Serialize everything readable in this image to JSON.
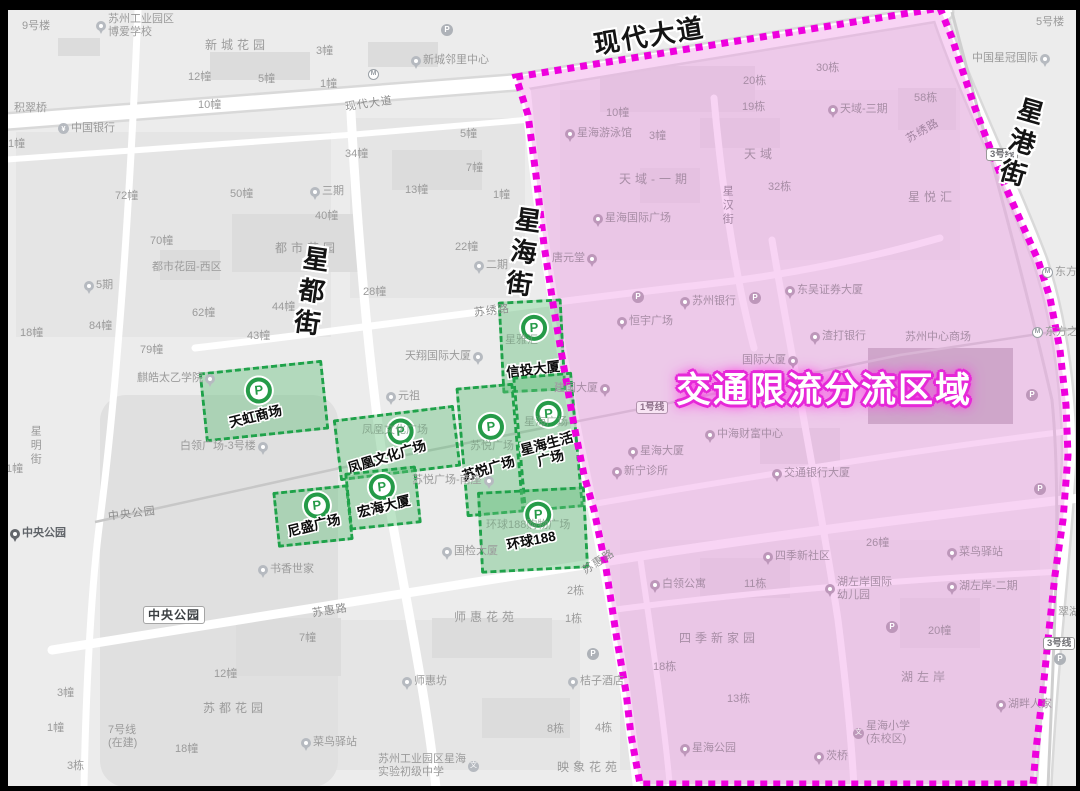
{
  "region": {
    "label": "交通限流分流区域",
    "title_x": 676,
    "title_y": 362,
    "border_color": "#ee00dd",
    "fill_color": "#ef9fe6"
  },
  "glyphs": {
    "parking": "P",
    "metro": "M",
    "school": "文",
    "bank": "¥"
  },
  "colors": {
    "zone_border": "#1fa24a",
    "zone_fill": "rgba(97,191,122,0.42)",
    "map_bg": "#ececec",
    "road": "#ffffff"
  },
  "streets_bold": [
    {
      "id": "xiandai-dadao",
      "name": "现代大道",
      "x": 593,
      "y": 16,
      "r": -9,
      "v": 0
    },
    {
      "id": "xinggang-jie",
      "name": "星港街",
      "x": 1002,
      "y": 96,
      "r": 16,
      "v": 1
    },
    {
      "id": "xinghai-jie",
      "name": "星海街",
      "x": 504,
      "y": 206,
      "r": 8,
      "v": 1
    },
    {
      "id": "xingdu-jie",
      "name": "星都街",
      "x": 292,
      "y": 245,
      "r": 8,
      "v": 1
    }
  ],
  "parking_zones": [
    {
      "id": "tianhong",
      "name": "天虹商场",
      "x": 202,
      "y": 366,
      "w": 124,
      "h": 70,
      "rot": -6,
      "px": 42,
      "py": 8,
      "lx": 22,
      "ly": 40,
      "lrot": -8,
      "lines": [
        "天虹商场"
      ]
    },
    {
      "id": "fenghuang",
      "name": "凤凰文化广场",
      "x": 336,
      "y": 412,
      "w": 122,
      "h": 62,
      "rot": -7,
      "px": 50,
      "py": 4,
      "lx": 6,
      "ly": 34,
      "lrot": -10,
      "lines": [
        "凤凰文化广场"
      ]
    },
    {
      "id": "xintou",
      "name": "信投大厦",
      "x": 500,
      "y": 300,
      "w": 64,
      "h": 92,
      "rot": -3,
      "px": 19,
      "py": 12,
      "lx": 2,
      "ly": 60,
      "lrot": -4,
      "lines": [
        "信投大厦"
      ]
    },
    {
      "id": "suyue",
      "name": "苏悦广场",
      "x": 461,
      "y": 385,
      "w": 58,
      "h": 130,
      "rot": -5,
      "px": 16,
      "py": 26,
      "lx": -4,
      "ly": 74,
      "lrot": -12,
      "lines": [
        "苏悦广场"
      ]
    },
    {
      "id": "xinghai-shenghuo",
      "name": "星海生活广场",
      "x": 518,
      "y": 374,
      "w": 60,
      "h": 136,
      "rot": -5,
      "px": 17,
      "py": 24,
      "lx": 0,
      "ly": 60,
      "lrot": -10,
      "lines": [
        "星海生活",
        "广场"
      ]
    },
    {
      "id": "nisheng",
      "name": "尼盛广场",
      "x": 275,
      "y": 488,
      "w": 76,
      "h": 56,
      "rot": -6,
      "px": 27,
      "py": 2,
      "lx": 8,
      "ly": 28,
      "lrot": -8,
      "lines": [
        "尼盛广场"
      ]
    },
    {
      "id": "honghai",
      "name": "宏海大厦",
      "x": 347,
      "y": 469,
      "w": 72,
      "h": 58,
      "rot": -6,
      "px": 20,
      "py": 2,
      "lx": 6,
      "ly": 28,
      "lrot": -8,
      "lines": [
        "宏海大厦"
      ]
    },
    {
      "id": "huanqiu188",
      "name": "环球188",
      "x": 479,
      "y": 489,
      "w": 108,
      "h": 82,
      "rot": -3,
      "px": 44,
      "py": 10,
      "lx": 24,
      "ly": 42,
      "lrot": -8,
      "lines": [
        "环球188"
      ]
    }
  ],
  "map_labels": [
    {
      "t": "9号楼",
      "x": 22,
      "y": 20
    },
    {
      "ml": [
        "苏州工业园区",
        "博爱学校"
      ],
      "x": 96,
      "y": 13,
      "i": "pin"
    },
    {
      "t": "新城花园",
      "x": 205,
      "y": 38,
      "sp": 1
    },
    {
      "t": "12幢",
      "x": 188,
      "y": 71
    },
    {
      "t": "5幢",
      "x": 258,
      "y": 73
    },
    {
      "t": "3幢",
      "x": 316,
      "y": 45
    },
    {
      "t": "1幢",
      "x": 320,
      "y": 78
    },
    {
      "t": "10幢",
      "x": 198,
      "y": 99
    },
    {
      "t": "现代大道",
      "x": 345,
      "y": 98,
      "r": -8,
      "road": 1
    },
    {
      "t": "新城邻里中心",
      "x": 411,
      "y": 54,
      "i": "pin"
    },
    {
      "t": "",
      "x": 441,
      "y": 24,
      "i": "P"
    },
    {
      "t": "",
      "x": 368,
      "y": 69,
      "i": "metro"
    },
    {
      "t": "积翠桥",
      "x": 14,
      "y": 102
    },
    {
      "t": "中国银行",
      "x": 58,
      "y": 122,
      "i": "bank"
    },
    {
      "t": "1幢",
      "x": 8,
      "y": 138
    },
    {
      "t": "72幢",
      "x": 115,
      "y": 190
    },
    {
      "t": "50幢",
      "x": 230,
      "y": 188
    },
    {
      "t": "三期",
      "x": 310,
      "y": 185,
      "i": "pin"
    },
    {
      "t": "40幢",
      "x": 315,
      "y": 210
    },
    {
      "t": "13幢",
      "x": 405,
      "y": 184
    },
    {
      "t": "1幢",
      "x": 493,
      "y": 189
    },
    {
      "t": "34幢",
      "x": 345,
      "y": 148
    },
    {
      "t": "5幢",
      "x": 460,
      "y": 128
    },
    {
      "t": "7幢",
      "x": 466,
      "y": 162
    },
    {
      "t": "都市花园",
      "x": 275,
      "y": 241,
      "sp": 1
    },
    {
      "t": "22幢",
      "x": 455,
      "y": 241
    },
    {
      "t": "二期",
      "x": 474,
      "y": 259,
      "i": "pin"
    },
    {
      "t": "28幢",
      "x": 363,
      "y": 286
    },
    {
      "t": "44幢",
      "x": 272,
      "y": 301
    },
    {
      "t": "43幢",
      "x": 247,
      "y": 330
    },
    {
      "t": "都市花园-西区",
      "x": 152,
      "y": 261
    },
    {
      "t": "5期",
      "x": 84,
      "y": 279,
      "i": "pin"
    },
    {
      "t": "84幢",
      "x": 89,
      "y": 320
    },
    {
      "t": "62幢",
      "x": 192,
      "y": 307
    },
    {
      "t": "79幢",
      "x": 140,
      "y": 344
    },
    {
      "t": "18幢",
      "x": 20,
      "y": 327
    },
    {
      "t": "70幢",
      "x": 150,
      "y": 235
    },
    {
      "t": "麒皓太乙学院",
      "x": 137,
      "y": 372,
      "i": "pin",
      "s": "r"
    },
    {
      "t": "星明街",
      "x": 28,
      "y": 425,
      "v": 1
    },
    {
      "t": "1幢",
      "x": 6,
      "y": 463
    },
    {
      "t": "白领广场-3号楼",
      "x": 180,
      "y": 440,
      "i": "pin",
      "s": "r"
    },
    {
      "t": "中央公园",
      "x": 108,
      "y": 508,
      "r": -7,
      "road": 1
    },
    {
      "t": "中央公园",
      "x": 10,
      "y": 527,
      "a": "d",
      "i": "pin"
    },
    {
      "t": "中央公园",
      "x": 143,
      "y": 606,
      "box": 1
    },
    {
      "t": "书香世家",
      "x": 258,
      "y": 563,
      "i": "pin"
    },
    {
      "t": "苏惠路",
      "x": 312,
      "y": 605,
      "r": -9,
      "road": 1
    },
    {
      "t": "苏惠路",
      "x": 581,
      "y": 556,
      "r": -33,
      "road": 1
    },
    {
      "t": "7幢",
      "x": 299,
      "y": 632
    },
    {
      "t": "12幢",
      "x": 214,
      "y": 668
    },
    {
      "t": "苏都花园",
      "x": 203,
      "y": 701,
      "sp": 1
    },
    {
      "t": "3幢",
      "x": 57,
      "y": 687
    },
    {
      "t": "1幢",
      "x": 47,
      "y": 722
    },
    {
      "ml": [
        "7号线",
        "(在建)"
      ],
      "x": 108,
      "y": 724
    },
    {
      "t": "18幢",
      "x": 175,
      "y": 743
    },
    {
      "t": "3栋",
      "x": 67,
      "y": 760
    },
    {
      "t": "菜鸟驿站",
      "x": 301,
      "y": 736,
      "i": "pin"
    },
    {
      "t": "师惠花苑",
      "x": 454,
      "y": 610,
      "sp": 1
    },
    {
      "t": "2栋",
      "x": 567,
      "y": 585
    },
    {
      "t": "1栋",
      "x": 565,
      "y": 613
    },
    {
      "t": "师惠坊",
      "x": 402,
      "y": 675,
      "i": "pin"
    },
    {
      "t": "桔子酒店",
      "x": 568,
      "y": 675,
      "i": "pin"
    },
    {
      "t": "",
      "x": 587,
      "y": 648,
      "i": "P"
    },
    {
      "t": "8栋",
      "x": 547,
      "y": 723
    },
    {
      "t": "4栋",
      "x": 595,
      "y": 722
    },
    {
      "ml": [
        "苏州工业园区星海",
        "实验初级中学"
      ],
      "x": 378,
      "y": 753,
      "i": "school",
      "s": "r"
    },
    {
      "t": "映象花苑",
      "x": 557,
      "y": 760,
      "sp": 1
    },
    {
      "t": "国检大厦",
      "x": 442,
      "y": 545,
      "i": "pin"
    },
    {
      "t": "元祖",
      "x": 386,
      "y": 390,
      "i": "pin"
    },
    {
      "t": "天翔国际大厦",
      "x": 405,
      "y": 350,
      "i": "pin",
      "s": "r"
    },
    {
      "t": "苏悦广场-南座",
      "x": 412,
      "y": 474,
      "i": "pin",
      "s": "r"
    },
    {
      "t": "苏绣路",
      "x": 474,
      "y": 305,
      "r": -7,
      "road": 1
    },
    {
      "t": "5号楼",
      "x": 1036,
      "y": 16
    },
    {
      "t": "中国星冠国际",
      "x": 972,
      "y": 52,
      "i": "pin",
      "s": "r"
    },
    {
      "t": "东方之门",
      "x": 1042,
      "y": 266,
      "i": "metro"
    },
    {
      "t": "东方之门",
      "x": 1032,
      "y": 326,
      "i": "metro"
    },
    {
      "t": "3号线",
      "x": 986,
      "y": 148,
      "badge": 1
    },
    {
      "t": "3号线",
      "x": 1043,
      "y": 637,
      "badge": 1
    },
    {
      "t": "",
      "x": 1054,
      "y": 653,
      "i": "P"
    },
    {
      "t": "翠湖雅苑",
      "x": 1058,
      "y": 606
    },
    {
      "t": "湖畔人家",
      "x": 996,
      "y": 698,
      "a": "p",
      "i": "pin"
    },
    {
      "t": "星海游泳馆",
      "x": 565,
      "y": 127,
      "a": "p",
      "i": "pin"
    },
    {
      "t": "10幢",
      "x": 606,
      "y": 107,
      "a": "p"
    },
    {
      "t": "3幢",
      "x": 649,
      "y": 130,
      "a": "p"
    },
    {
      "t": "天域-一期",
      "x": 619,
      "y": 172,
      "a": "p",
      "sp": 1
    },
    {
      "t": "天域",
      "x": 744,
      "y": 147,
      "a": "p",
      "sp": 1
    },
    {
      "t": "20栋",
      "x": 743,
      "y": 75,
      "a": "p"
    },
    {
      "t": "30栋",
      "x": 816,
      "y": 62,
      "a": "p"
    },
    {
      "t": "19栋",
      "x": 742,
      "y": 101,
      "a": "p"
    },
    {
      "t": "58栋",
      "x": 914,
      "y": 92,
      "a": "p"
    },
    {
      "t": "天域-三期",
      "x": 828,
      "y": 103,
      "a": "p",
      "i": "pin"
    },
    {
      "t": "32栋",
      "x": 768,
      "y": 181,
      "a": "p"
    },
    {
      "t": "星汉街",
      "x": 720,
      "y": 185,
      "a": "p",
      "v": 1,
      "road": 1
    },
    {
      "t": "星海国际广场",
      "x": 593,
      "y": 212,
      "a": "p",
      "i": "pin"
    },
    {
      "t": "星悦汇",
      "x": 908,
      "y": 190,
      "a": "p",
      "sp": 1
    },
    {
      "t": "苏绣路",
      "x": 905,
      "y": 125,
      "a": "p",
      "r": -30,
      "road": 1
    },
    {
      "t": "唐元堂",
      "x": 552,
      "y": 252,
      "a": "p",
      "i": "pin",
      "s": "r"
    },
    {
      "t": "恒宇广场",
      "x": 617,
      "y": 315,
      "a": "p",
      "i": "pin"
    },
    {
      "t": "苏州银行",
      "x": 680,
      "y": 295,
      "a": "p",
      "i": "pin"
    },
    {
      "t": "",
      "x": 632,
      "y": 291,
      "a": "p",
      "i": "P"
    },
    {
      "t": "东吴证券大厦",
      "x": 785,
      "y": 284,
      "a": "p",
      "i": "pin"
    },
    {
      "t": "",
      "x": 749,
      "y": 292,
      "a": "p",
      "i": "P"
    },
    {
      "t": "渣打银行",
      "x": 810,
      "y": 330,
      "a": "p",
      "i": "pin"
    },
    {
      "t": "苏州中心商场",
      "x": 905,
      "y": 331,
      "a": "p"
    },
    {
      "t": "国际大厦",
      "x": 742,
      "y": 354,
      "a": "p",
      "i": "pin",
      "s": "r"
    },
    {
      "t": "1号线",
      "x": 636,
      "y": 401,
      "a": "p",
      "badge": 1
    },
    {
      "t": "中海财富中心",
      "x": 705,
      "y": 428,
      "a": "p",
      "i": "pin"
    },
    {
      "t": "星海大厦",
      "x": 628,
      "y": 445,
      "a": "p",
      "i": "pin"
    },
    {
      "t": "新宁诊所",
      "x": 612,
      "y": 465,
      "a": "p",
      "i": "pin"
    },
    {
      "t": "交通银行大厦",
      "x": 772,
      "y": 467,
      "a": "p",
      "i": "pin"
    },
    {
      "t": "",
      "x": 1026,
      "y": 389,
      "a": "p",
      "i": "P"
    },
    {
      "t": "",
      "x": 1034,
      "y": 483,
      "a": "p",
      "i": "P"
    },
    {
      "t": "菜鸟驿站",
      "x": 947,
      "y": 546,
      "a": "p",
      "i": "pin"
    },
    {
      "t": "四季新社区",
      "x": 763,
      "y": 550,
      "a": "p",
      "i": "pin"
    },
    {
      "t": "26幢",
      "x": 866,
      "y": 537,
      "a": "p"
    },
    {
      "t": "白领公寓",
      "x": 650,
      "y": 578,
      "a": "p",
      "i": "pin"
    },
    {
      "t": "11栋",
      "x": 744,
      "y": 578,
      "a": "p"
    },
    {
      "ml": [
        "湖左岸国际",
        "幼儿园"
      ],
      "x": 825,
      "y": 576,
      "a": "p",
      "i": "pin"
    },
    {
      "t": "湖左岸-二期",
      "x": 947,
      "y": 580,
      "a": "p",
      "i": "pin"
    },
    {
      "t": "四季新家园",
      "x": 679,
      "y": 631,
      "a": "p",
      "sp": 1
    },
    {
      "t": "20幢",
      "x": 928,
      "y": 625,
      "a": "p"
    },
    {
      "t": "18栋",
      "x": 653,
      "y": 661,
      "a": "p"
    },
    {
      "t": "湖左岸",
      "x": 901,
      "y": 670,
      "a": "p",
      "sp": 1
    },
    {
      "t": "13栋",
      "x": 727,
      "y": 693,
      "a": "p"
    },
    {
      "t": "",
      "x": 886,
      "y": 621,
      "a": "p",
      "i": "P"
    },
    {
      "ml": [
        "星海小学",
        "(东校区)"
      ],
      "x": 853,
      "y": 720,
      "a": "p",
      "i": "school"
    },
    {
      "t": "星海公园",
      "x": 680,
      "y": 742,
      "a": "p",
      "i": "pin"
    },
    {
      "t": "茨桥",
      "x": 814,
      "y": 750,
      "a": "p",
      "i": "pin"
    },
    {
      "t": "建国大厦",
      "x": 554,
      "y": 382,
      "a": "p",
      "i": "pin",
      "s": "r"
    },
    {
      "t": "星雅汇",
      "x": 505,
      "y": 334,
      "a": "u"
    },
    {
      "t": "星海广场",
      "x": 524,
      "y": 416,
      "a": "u"
    },
    {
      "t": "凤凰文化广场",
      "x": 362,
      "y": 424,
      "a": "u"
    },
    {
      "t": "苏悦广场",
      "x": 470,
      "y": 440,
      "a": "u"
    },
    {
      "t": "环球188购物广场",
      "x": 486,
      "y": 519,
      "a": "u"
    }
  ]
}
